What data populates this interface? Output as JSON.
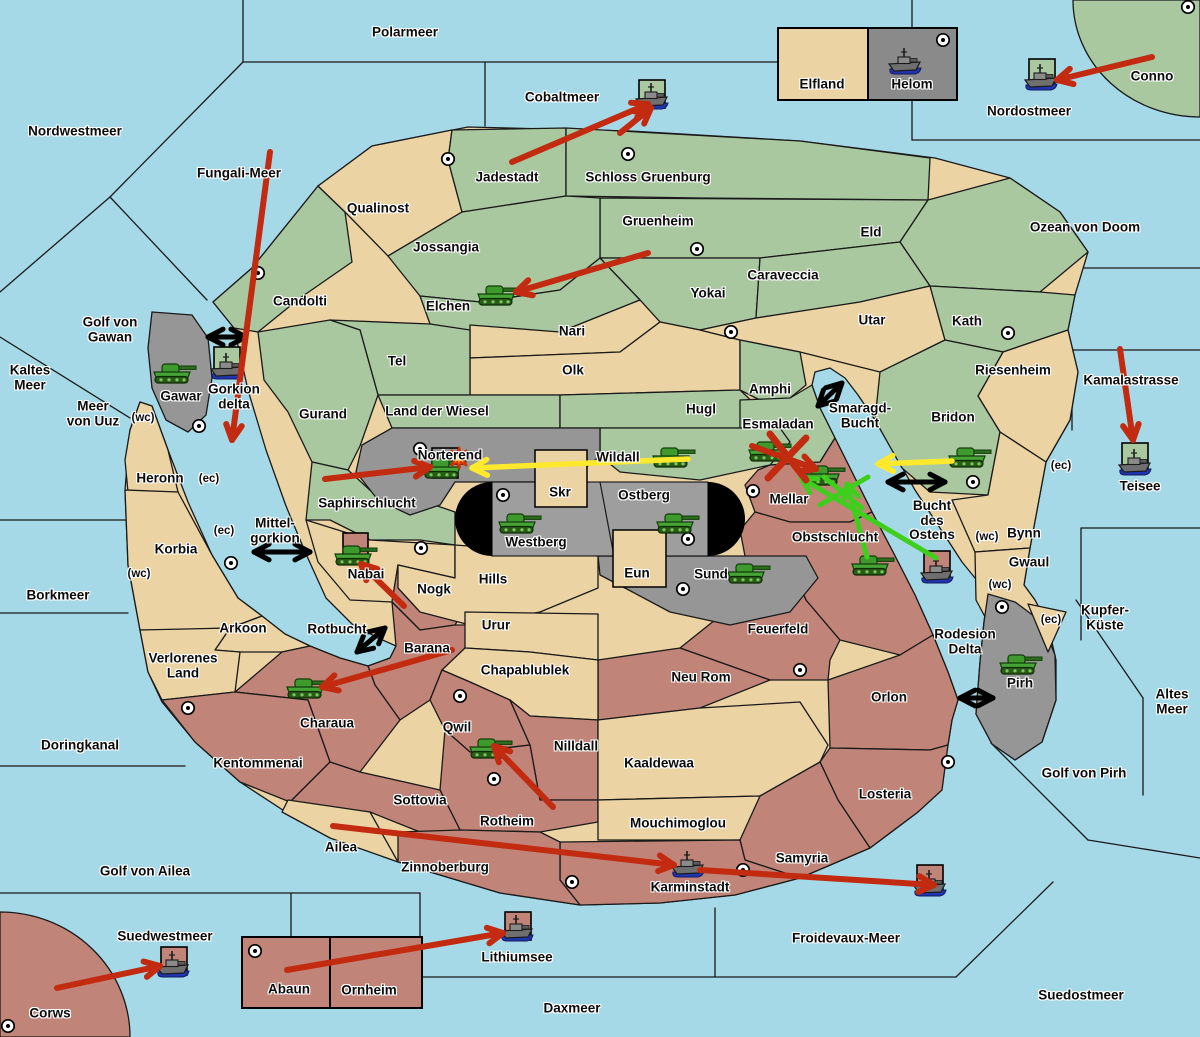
{
  "title": "Wargame strategy map",
  "colors": {
    "ocean": "#a6d9e7",
    "green_territory": "#a9c8a0",
    "tan_territory": "#ebd3a3",
    "red_territory": "#c08478",
    "gray_territory": "#969696",
    "gray_dark": "#8a8a8a",
    "capsule_black": "#000000",
    "arrow_red": "#c32b11",
    "arrow_yellow": "#ffe92c",
    "arrow_green": "#3ecf1d",
    "arrow_black": "#000000",
    "border": "#1a1a1a"
  },
  "sea_labels": [
    {
      "name": "polarmeer",
      "text": "Polarmeer",
      "x": 405,
      "y": 33
    },
    {
      "name": "nordwestmeer",
      "text": "Nordwestmeer",
      "x": 75,
      "y": 132
    },
    {
      "name": "fungali-meer",
      "text": "Fungali-Meer",
      "x": 239,
      "y": 174
    },
    {
      "name": "cobaltmeer",
      "text": "Cobaltmeer",
      "x": 562,
      "y": 98
    },
    {
      "name": "nordostmeer",
      "text": "Nordostmeer",
      "x": 1029,
      "y": 112
    },
    {
      "name": "ozean-von-doom",
      "text": "Ozean von Doom",
      "x": 1085,
      "y": 228
    },
    {
      "name": "golf-von-gawan",
      "text": "Golf von\nGawan",
      "x": 110,
      "y": 330
    },
    {
      "name": "kaltes-meer",
      "text": "Kaltes\nMeer",
      "x": 30,
      "y": 378
    },
    {
      "name": "meer-von-uuz",
      "text": "Meer\nvon Uuz",
      "x": 93,
      "y": 414
    },
    {
      "name": "gorkion-delta",
      "text": "Gorkion\ndelta",
      "x": 234,
      "y": 397
    },
    {
      "name": "mittel-gorkion",
      "text": "Mittel-\ngorkion",
      "x": 275,
      "y": 531
    },
    {
      "name": "borkmeer",
      "text": "Borkmeer",
      "x": 58,
      "y": 596
    },
    {
      "name": "rotbucht",
      "text": "Rotbucht",
      "x": 337,
      "y": 630
    },
    {
      "name": "doringkanal",
      "text": "Doringkanal",
      "x": 80,
      "y": 746
    },
    {
      "name": "golf-von-ailea",
      "text": "Golf von Ailea",
      "x": 145,
      "y": 872
    },
    {
      "name": "suedwestmeer",
      "text": "Suedwestmeer",
      "x": 165,
      "y": 937
    },
    {
      "name": "daxmeer",
      "text": "Daxmeer",
      "x": 572,
      "y": 1009
    },
    {
      "name": "lithiumsee",
      "text": "Lithiumsee",
      "x": 517,
      "y": 958
    },
    {
      "name": "froidevaux-meer",
      "text": "Froidevaux-Meer",
      "x": 846,
      "y": 939
    },
    {
      "name": "suedostmeer",
      "text": "Suedostmeer",
      "x": 1081,
      "y": 996
    },
    {
      "name": "golf-von-pirh",
      "text": "Golf von Pirh",
      "x": 1084,
      "y": 774
    },
    {
      "name": "altes-meer",
      "text": "Altes\nMeer",
      "x": 1172,
      "y": 702
    },
    {
      "name": "kupfer-kueste",
      "text": "Kupfer-\nKüste",
      "x": 1105,
      "y": 618
    },
    {
      "name": "kamalastrasse",
      "text": "Kamalastrasse",
      "x": 1131,
      "y": 381
    },
    {
      "name": "teisee",
      "text": "Teisee",
      "x": 1140,
      "y": 487
    },
    {
      "name": "smaragd-bucht",
      "text": "Smaragd-\nBucht",
      "x": 860,
      "y": 416
    },
    {
      "name": "bucht-des-ostens",
      "text": "Bucht\ndes\nOstens",
      "x": 932,
      "y": 521
    },
    {
      "name": "rodesion-delta",
      "text": "Rodesion\nDelta",
      "x": 965,
      "y": 642
    }
  ],
  "land_labels": [
    {
      "name": "qualinost",
      "text": "Qualinost",
      "x": 378,
      "y": 209
    },
    {
      "name": "jadestadt",
      "text": "Jadestadt",
      "x": 507,
      "y": 178
    },
    {
      "name": "schloss-gruenburg",
      "text": "Schloss Gruenburg",
      "x": 648,
      "y": 178
    },
    {
      "name": "gruenheim",
      "text": "Gruenheim",
      "x": 658,
      "y": 222
    },
    {
      "name": "jossangia",
      "text": "Jossangia",
      "x": 446,
      "y": 248
    },
    {
      "name": "candolti",
      "text": "Candolti",
      "x": 300,
      "y": 302
    },
    {
      "name": "elchen",
      "text": "Elchen",
      "x": 448,
      "y": 307
    },
    {
      "name": "yokai",
      "text": "Yokai",
      "x": 708,
      "y": 294
    },
    {
      "name": "caraveccia",
      "text": "Caraveccia",
      "x": 783,
      "y": 276
    },
    {
      "name": "eld",
      "text": "Eld",
      "x": 871,
      "y": 233
    },
    {
      "name": "utar",
      "text": "Utar",
      "x": 872,
      "y": 321
    },
    {
      "name": "kath",
      "text": "Kath",
      "x": 967,
      "y": 322
    },
    {
      "name": "nari",
      "text": "Nari",
      "x": 572,
      "y": 332
    },
    {
      "name": "olk",
      "text": "Olk",
      "x": 573,
      "y": 371
    },
    {
      "name": "tel",
      "text": "Tel",
      "x": 397,
      "y": 362
    },
    {
      "name": "gurand",
      "text": "Gurand",
      "x": 323,
      "y": 415
    },
    {
      "name": "land-der-wiesel",
      "text": "Land der Wiesel",
      "x": 437,
      "y": 412
    },
    {
      "name": "hugl",
      "text": "Hugl",
      "x": 701,
      "y": 410
    },
    {
      "name": "amphi",
      "text": "Amphi",
      "x": 770,
      "y": 390
    },
    {
      "name": "esmaladan",
      "text": "Esmaladan",
      "x": 778,
      "y": 425
    },
    {
      "name": "riesenheim",
      "text": "Riesenheim",
      "x": 1013,
      "y": 371
    },
    {
      "name": "bridon",
      "text": "Bridon",
      "x": 953,
      "y": 418
    },
    {
      "name": "gawar",
      "text": "Gawar",
      "x": 181,
      "y": 397
    },
    {
      "name": "heronn",
      "text": "Heronn",
      "x": 160,
      "y": 479
    },
    {
      "name": "korbia",
      "text": "Korbia",
      "x": 176,
      "y": 550
    },
    {
      "name": "saphirschlucht",
      "text": "Saphirschlucht",
      "x": 367,
      "y": 504
    },
    {
      "name": "norterend",
      "text": "Norterend",
      "x": 450,
      "y": 456
    },
    {
      "name": "wildall",
      "text": "Wildall",
      "x": 618,
      "y": 458
    },
    {
      "name": "skr",
      "text": "Skr",
      "x": 560,
      "y": 493
    },
    {
      "name": "ostberg",
      "text": "Ostberg",
      "x": 644,
      "y": 496
    },
    {
      "name": "westberg",
      "text": "Westberg",
      "x": 536,
      "y": 543
    },
    {
      "name": "eun",
      "text": "Eun",
      "x": 637,
      "y": 574
    },
    {
      "name": "sund",
      "text": "Sund",
      "x": 711,
      "y": 575
    },
    {
      "name": "hills",
      "text": "Hills",
      "x": 493,
      "y": 580
    },
    {
      "name": "mellar",
      "text": "Mellar",
      "x": 789,
      "y": 500
    },
    {
      "name": "obstschlucht",
      "text": "Obstschlucht",
      "x": 835,
      "y": 538
    },
    {
      "name": "nabai",
      "text": "Nabai",
      "x": 366,
      "y": 575
    },
    {
      "name": "nogk",
      "text": "Nogk",
      "x": 434,
      "y": 590
    },
    {
      "name": "barana",
      "text": "Barana",
      "x": 427,
      "y": 649
    },
    {
      "name": "urur",
      "text": "Urur",
      "x": 496,
      "y": 626
    },
    {
      "name": "chapablublek",
      "text": "Chapablublek",
      "x": 525,
      "y": 671
    },
    {
      "name": "nilldall",
      "text": "Nilldall",
      "x": 576,
      "y": 747
    },
    {
      "name": "kaaldewaa",
      "text": "Kaaldewaa",
      "x": 659,
      "y": 764
    },
    {
      "name": "neu-rom",
      "text": "Neu Rom",
      "x": 701,
      "y": 678
    },
    {
      "name": "feuerfeld",
      "text": "Feuerfeld",
      "x": 778,
      "y": 630
    },
    {
      "name": "qwil",
      "text": "Qwil",
      "x": 457,
      "y": 728
    },
    {
      "name": "rotheim",
      "text": "Rotheim",
      "x": 507,
      "y": 822
    },
    {
      "name": "sottovia",
      "text": "Sottovia",
      "x": 420,
      "y": 801
    },
    {
      "name": "mouchimoglou",
      "text": "Mouchimoglou",
      "x": 678,
      "y": 824
    },
    {
      "name": "zinnoberburg",
      "text": "Zinnoberburg",
      "x": 445,
      "y": 868
    },
    {
      "name": "karminstadt",
      "text": "Karminstadt",
      "x": 690,
      "y": 888
    },
    {
      "name": "samyria",
      "text": "Samyria",
      "x": 802,
      "y": 859
    },
    {
      "name": "losteria",
      "text": "Losteria",
      "x": 885,
      "y": 795
    },
    {
      "name": "orlon",
      "text": "Orlon",
      "x": 889,
      "y": 698
    },
    {
      "name": "kentommenai",
      "text": "Kentommenai",
      "x": 258,
      "y": 764
    },
    {
      "name": "charaua",
      "text": "Charaua",
      "x": 327,
      "y": 724
    },
    {
      "name": "verlorenes-land",
      "text": "Verlorenes\nLand",
      "x": 183,
      "y": 666
    },
    {
      "name": "arkoon",
      "text": "Arkoon",
      "x": 243,
      "y": 629
    },
    {
      "name": "ailea",
      "text": "Ailea",
      "x": 341,
      "y": 848
    },
    {
      "name": "abaun",
      "text": "Abaun",
      "x": 289,
      "y": 990
    },
    {
      "name": "ornheim",
      "text": "Ornheim",
      "x": 369,
      "y": 991
    },
    {
      "name": "corws",
      "text": "Corws",
      "x": 50,
      "y": 1014
    },
    {
      "name": "conno",
      "text": "Conno",
      "x": 1152,
      "y": 77
    },
    {
      "name": "elfland",
      "text": "Elfland",
      "x": 822,
      "y": 85
    },
    {
      "name": "helom",
      "text": "Helom",
      "x": 912,
      "y": 85
    },
    {
      "name": "bynn",
      "text": "Bynn",
      "x": 1024,
      "y": 534
    },
    {
      "name": "gwaul",
      "text": "Gwaul",
      "x": 1029,
      "y": 563
    },
    {
      "name": "pirh",
      "text": "Pirh",
      "x": 1020,
      "y": 684
    }
  ],
  "coast_tags": [
    {
      "text": "(wc)",
      "x": 143,
      "y": 418
    },
    {
      "text": "(wc)",
      "x": 139,
      "y": 574
    },
    {
      "text": "(wc)",
      "x": 987,
      "y": 537
    },
    {
      "text": "(wc)",
      "x": 1000,
      "y": 585
    },
    {
      "text": "(ec)",
      "x": 209,
      "y": 479
    },
    {
      "text": "(ec)",
      "x": 224,
      "y": 531
    },
    {
      "text": "(ec)",
      "x": 1061,
      "y": 466
    },
    {
      "text": "(ec)",
      "x": 1051,
      "y": 620
    }
  ],
  "towns": [
    {
      "x": 448,
      "y": 159
    },
    {
      "x": 628,
      "y": 154
    },
    {
      "x": 697,
      "y": 249
    },
    {
      "x": 258,
      "y": 273
    },
    {
      "x": 1188,
      "y": 7
    },
    {
      "x": 943,
      "y": 40
    },
    {
      "x": 731,
      "y": 332
    },
    {
      "x": 1008,
      "y": 333
    },
    {
      "x": 199,
      "y": 426
    },
    {
      "x": 420,
      "y": 449
    },
    {
      "x": 503,
      "y": 495
    },
    {
      "x": 688,
      "y": 539
    },
    {
      "x": 683,
      "y": 589
    },
    {
      "x": 421,
      "y": 548
    },
    {
      "x": 753,
      "y": 491
    },
    {
      "x": 973,
      "y": 482
    },
    {
      "x": 231,
      "y": 563
    },
    {
      "x": 188,
      "y": 708
    },
    {
      "x": 460,
      "y": 696
    },
    {
      "x": 494,
      "y": 779
    },
    {
      "x": 572,
      "y": 882
    },
    {
      "x": 743,
      "y": 870
    },
    {
      "x": 948,
      "y": 762
    },
    {
      "x": 800,
      "y": 670
    },
    {
      "x": 1002,
      "y": 607
    },
    {
      "x": 255,
      "y": 951
    },
    {
      "x": 8,
      "y": 1026
    }
  ],
  "tanks": [
    {
      "territory": "elchen",
      "x": 497,
      "y": 296
    },
    {
      "territory": "gawar",
      "x": 173,
      "y": 374
    },
    {
      "territory": "norterend",
      "x": 443,
      "y": 469
    },
    {
      "territory": "wildall",
      "x": 672,
      "y": 458
    },
    {
      "territory": "esmaladan",
      "x": 768,
      "y": 452
    },
    {
      "territory": "mellar",
      "x": 822,
      "y": 476
    },
    {
      "territory": "bridon",
      "x": 968,
      "y": 458
    },
    {
      "territory": "westberg",
      "x": 518,
      "y": 524
    },
    {
      "territory": "ostberg",
      "x": 676,
      "y": 524
    },
    {
      "territory": "sund",
      "x": 747,
      "y": 574
    },
    {
      "territory": "obstschlucht",
      "x": 871,
      "y": 566
    },
    {
      "territory": "nabai",
      "x": 354,
      "y": 556
    },
    {
      "territory": "charaua",
      "x": 306,
      "y": 689
    },
    {
      "territory": "qwil",
      "x": 489,
      "y": 749
    },
    {
      "territory": "pirh",
      "x": 1019,
      "y": 665
    }
  ],
  "ships": [
    {
      "location": "cobaltmeer",
      "x": 652,
      "y": 96,
      "box": [
        639,
        80
      ],
      "box_color": "green"
    },
    {
      "location": "helom",
      "x": 905,
      "y": 61,
      "box": null,
      "box_color": null
    },
    {
      "location": "nordostmeer",
      "x": 1041,
      "y": 77,
      "box": [
        1029,
        59
      ],
      "box_color": "green"
    },
    {
      "location": "gorkion-delta",
      "x": 227,
      "y": 366,
      "box": [
        214,
        347
      ],
      "box_color": "green"
    },
    {
      "location": "teisee",
      "x": 1135,
      "y": 462,
      "box": [
        1122,
        443
      ],
      "box_color": "green"
    },
    {
      "location": "bucht-des-ostens",
      "x": 937,
      "y": 570,
      "box": [
        924,
        551
      ],
      "box_color": "red"
    },
    {
      "location": "karminstadt",
      "x": 688,
      "y": 864,
      "box": null,
      "box_color": null
    },
    {
      "location": "froidevaux-meer",
      "x": 930,
      "y": 883,
      "box": [
        917,
        865
      ],
      "box_color": "red"
    },
    {
      "location": "suedwestmeer",
      "x": 173,
      "y": 964,
      "box": [
        161,
        947
      ],
      "box_color": "red"
    },
    {
      "location": "lithiumsee",
      "x": 517,
      "y": 928,
      "box": [
        505,
        912
      ],
      "box_color": "red"
    }
  ],
  "city_tiles": [
    {
      "name": "nabai-tile",
      "x": 343,
      "y": 533,
      "w": 25,
      "h": 27,
      "color": "red"
    },
    {
      "name": "norterend-empty-box",
      "x": 432,
      "y": 448,
      "w": 26,
      "h": 30,
      "color": "none"
    }
  ],
  "arrows": {
    "red": [
      {
        "x1": 270,
        "y1": 152,
        "x2": 232,
        "y2": 440
      },
      {
        "x1": 512,
        "y1": 162,
        "x2": 648,
        "y2": 104
      },
      {
        "x1": 620,
        "y1": 133,
        "x2": 651,
        "y2": 108
      },
      {
        "x1": 648,
        "y1": 253,
        "x2": 516,
        "y2": 292
      },
      {
        "x1": 1152,
        "y1": 57,
        "x2": 1057,
        "y2": 80
      },
      {
        "x1": 1120,
        "y1": 349,
        "x2": 1133,
        "y2": 440
      },
      {
        "x1": 325,
        "y1": 479,
        "x2": 430,
        "y2": 467
      },
      {
        "x1": 404,
        "y1": 606,
        "x2": 361,
        "y2": 564
      },
      {
        "x1": 452,
        "y1": 650,
        "x2": 322,
        "y2": 687
      },
      {
        "x1": 553,
        "y1": 807,
        "x2": 494,
        "y2": 746
      },
      {
        "x1": 333,
        "y1": 826,
        "x2": 674,
        "y2": 865
      },
      {
        "x1": 700,
        "y1": 870,
        "x2": 934,
        "y2": 885
      },
      {
        "x1": 57,
        "y1": 988,
        "x2": 160,
        "y2": 966
      },
      {
        "x1": 287,
        "y1": 970,
        "x2": 503,
        "y2": 933
      },
      {
        "x1": 752,
        "y1": 446,
        "x2": 816,
        "y2": 469
      }
    ],
    "yellow": [
      {
        "x1": 688,
        "y1": 459,
        "x2": 472,
        "y2": 468
      },
      {
        "x1": 952,
        "y1": 461,
        "x2": 878,
        "y2": 464
      }
    ],
    "green": [
      {
        "x1": 936,
        "y1": 558,
        "x2": 801,
        "y2": 478
      },
      {
        "x1": 867,
        "y1": 557,
        "x2": 847,
        "y2": 484
      }
    ],
    "green_strokes": [
      {
        "x1": 820,
        "y1": 505,
        "x2": 868,
        "y2": 477
      },
      {
        "x1": 824,
        "y1": 477,
        "x2": 862,
        "y2": 508
      }
    ],
    "black_double": [
      {
        "x1": 208,
        "y1": 337,
        "x2": 246,
        "y2": 337
      },
      {
        "x1": 254,
        "y1": 552,
        "x2": 310,
        "y2": 552
      },
      {
        "x1": 357,
        "y1": 652,
        "x2": 385,
        "y2": 628
      },
      {
        "x1": 818,
        "y1": 406,
        "x2": 842,
        "y2": 383
      },
      {
        "x1": 888,
        "y1": 482,
        "x2": 945,
        "y2": 482
      },
      {
        "x1": 960,
        "y1": 698,
        "x2": 993,
        "y2": 698
      }
    ],
    "red_battle_x": [
      {
        "x1": 770,
        "y1": 434,
        "x2": 806,
        "y2": 480
      },
      {
        "x1": 806,
        "y1": 438,
        "x2": 768,
        "y2": 478
      }
    ]
  },
  "explosion_marker": {
    "x": 459,
    "y": 458
  }
}
